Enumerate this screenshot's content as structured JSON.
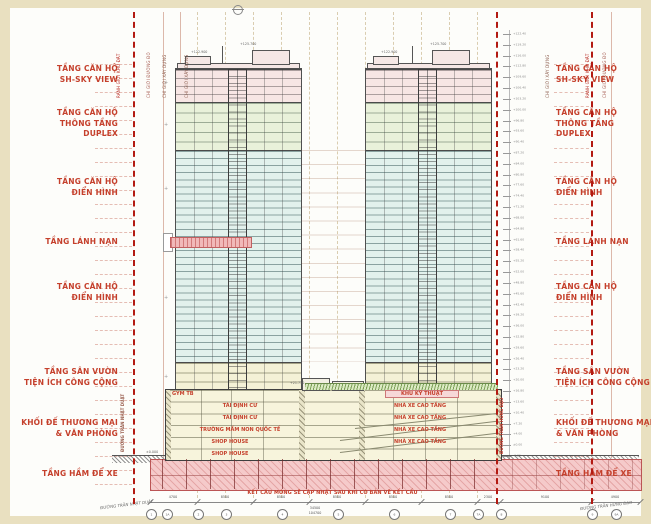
{
  "zones": [
    {
      "lines": [
        "TẦNG CĂN HỘ",
        "SH-SKY VIEW"
      ]
    },
    {
      "lines": [
        "TẦNG CĂN HỘ",
        "THÔNG TẦNG",
        "DUPLEX"
      ]
    },
    {
      "lines": [
        "TẦNG CĂN HỘ",
        "ĐIỂN HÌNH"
      ]
    },
    {
      "lines": [
        "TẦNG LÁNH NẠN"
      ]
    },
    {
      "lines": [
        "TẦNG CĂN HỘ",
        "ĐIỂN HÌNH"
      ]
    },
    {
      "lines": [
        "TẦNG SÂN VƯỜN",
        "TIỆN ÍCH CÔNG CỘNG"
      ]
    },
    {
      "lines": [
        "KHỐI ĐẾ THƯƠNG MẠI",
        "& VĂN PHÒNG"
      ]
    },
    {
      "lines": [
        "TẦNG HẦM ĐỂ XE"
      ]
    }
  ],
  "podium": {
    "left_rooms": [
      "GYM TB",
      "TÁI ĐỊNH CƯ",
      "TÁI ĐỊNH CƯ",
      "TRƯỜNG MẦM NON QUỐC TẾ",
      "SHOP HOUSE",
      "SHOP HOUSE"
    ],
    "right_rooms": [
      "KHU KỸ THUẬT",
      "NHÀ XE CAO TẦNG",
      "NHÀ XE CAO TẦNG",
      "NHÀ XE CAO TẦNG",
      "NHÀ XE CAO TẦNG"
    ]
  },
  "elevations": {
    "tower_peak": "+125.700",
    "tower_roof": "+122.900",
    "podium_top": "+21.750",
    "ground": "±0.000"
  },
  "boundaries": {
    "site": "RANH GIỚI KHU ĐẤT",
    "red_line": "CHỈ GIỚI ĐƯỜNG ĐỎ",
    "build_line": "CHỈ GIỚI XÂY DỰNG"
  },
  "streets": {
    "left": "ĐƯỜNG TRẦN NHẬT DUẬT",
    "right": "ĐƯỜNG TRẦN HƯNG ĐẠO"
  },
  "note": "KẾT CẤU MÓNG SẼ CẬP NHẬT SAU KHI CÓ BẢN VẼ KẾT CẤU",
  "levels": [
    "+122.40",
    "+119.20",
    "+116.00",
    "+112.80",
    "+109.60",
    "+106.40",
    "+103.20",
    "+100.00",
    "+96.80",
    "+93.60",
    "+90.40",
    "+87.20",
    "+84.00",
    "+80.80",
    "+77.60",
    "+74.40",
    "+71.20",
    "+68.00",
    "+64.80",
    "+61.60",
    "+58.40",
    "+55.20",
    "+52.00",
    "+48.80",
    "+45.60",
    "+42.40",
    "+39.20",
    "+36.00",
    "+32.80",
    "+29.60",
    "+26.40",
    "+23.20",
    "+20.00",
    "+16.80",
    "+13.60",
    "+10.40",
    "+7.20",
    "+4.00",
    "±0.00",
    "-3.20"
  ],
  "dims": {
    "segments": [
      "4700",
      "8500",
      "8500",
      "8500",
      "8500",
      "8500",
      "2300",
      "9100",
      "4900"
    ],
    "totals": [
      "34500",
      "104700"
    ]
  },
  "grid_bubbles": [
    "1",
    "1A",
    "2",
    "3",
    "4",
    "5",
    "6",
    "7",
    "7A",
    "8",
    "9",
    "9A"
  ],
  "colors": {
    "label_red": "#c5402c",
    "boundary_red": "#b31a12",
    "zone_pink": "#f7e6e4",
    "zone_green": "#e9f1da",
    "zone_cyan": "#e2f1ec",
    "zone_amenity": "#f4f1d6",
    "podium_fill": "#f7f4dc",
    "basement_pink": "#f5caca",
    "refuge_pink": "#f1b9b9",
    "frame_cream": "#e9e0c0"
  }
}
